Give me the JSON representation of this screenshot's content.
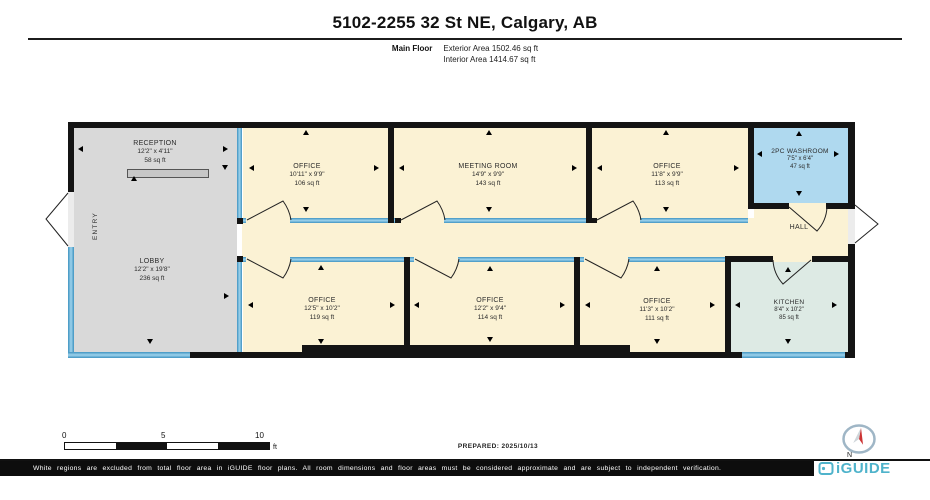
{
  "header": {
    "title": "5102-2255 32 St NE, Calgary, AB",
    "floor_label": "Main Floor",
    "exterior_area": "Exterior Area 1502.46 sq ft",
    "interior_area": "Interior Area 1414.67 sq ft"
  },
  "rooms": {
    "reception": {
      "name": "RECEPTION",
      "dims": "12'2\" x 4'11\"",
      "area": "58 sq ft"
    },
    "lobby": {
      "name": "LOBBY",
      "dims": "12'2\" x 19'8\"",
      "area": "236 sq ft"
    },
    "entry": {
      "name": "ENTRY"
    },
    "office1": {
      "name": "OFFICE",
      "dims": "10'11\" x 9'9\"",
      "area": "106 sq ft"
    },
    "meeting": {
      "name": "MEETING ROOM",
      "dims": "14'9\" x 9'9\"",
      "area": "143 sq ft"
    },
    "office2": {
      "name": "OFFICE",
      "dims": "11'8\" x 9'9\"",
      "area": "113 sq ft"
    },
    "washroom": {
      "name": "2PC WASHROOM",
      "dims": "7'5\" x 6'4\"",
      "area": "47 sq ft"
    },
    "hall": {
      "name": "HALL"
    },
    "office3": {
      "name": "OFFICE",
      "dims": "12'5\" x 10'2\"",
      "area": "119 sq ft"
    },
    "office4": {
      "name": "OFFICE",
      "dims": "12'2\" x 9'4\"",
      "area": "114 sq ft"
    },
    "office5": {
      "name": "OFFICE",
      "dims": "11'3\" x 10'2\"",
      "area": "111 sq ft"
    },
    "kitchen": {
      "name": "KITCHEN",
      "dims": "8'4\" x 10'2\"",
      "area": "85 sq ft"
    }
  },
  "scale": {
    "t0": "0",
    "t5": "5",
    "t10": "10",
    "unit": "ft"
  },
  "footer": {
    "prepared": "PREPARED: 2025/10/13",
    "north": "N",
    "disclaimer": "White regions are excluded from total floor area in iGUIDE floor plans. All room dimensions and floor areas must be considered approximate and are subject to independent verification.",
    "brand": "iGUIDE"
  },
  "icons": {
    "compass_needle": "compass-needle",
    "dimension_arrow": "triangle-arrow",
    "door_swing": "quarter-arc",
    "brand_mark": "iguide-square"
  },
  "colors": {
    "cream": "#FBF2D4",
    "gray": "#D9D9D9",
    "washroom_blue": "#AFD9EF",
    "kitchen_teal": "#DDEAE4",
    "window_blue": "#4D9FC7",
    "wall_black": "#141414",
    "brand_teal": "#4FB3CB",
    "compass_red": "#CC3333"
  }
}
